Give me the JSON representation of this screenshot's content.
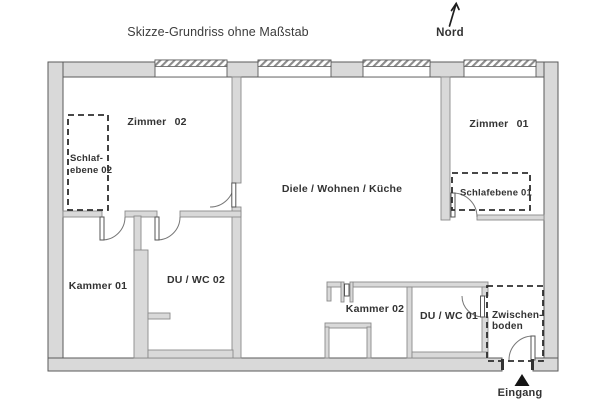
{
  "title": "Skizze-Grundriss ohne Maßstab",
  "compass": {
    "label": "Nord",
    "icon": "north-arrow-icon"
  },
  "entrance": {
    "label": "Eingang",
    "icon": "entrance-triangle-icon"
  },
  "rooms": {
    "zimmer02": {
      "label": "Zimmer 02"
    },
    "zimmer01": {
      "label": "Zimmer 01"
    },
    "diele": {
      "label": "Diele / Wohnen / Küche"
    },
    "kammer01": {
      "label": "Kammer 01"
    },
    "kammer02": {
      "label": "Kammer 02"
    },
    "du_wc_02": {
      "label": "DU / WC 02"
    },
    "du_wc_01": {
      "label": "DU / WC 01"
    },
    "schlafebene02": {
      "line1": "Schlaf-",
      "line2": "ebene 02"
    },
    "schlafebene01": {
      "label": "Schlafebene 01"
    },
    "zwischenboden": {
      "line1": "Zwischen-",
      "line2": "boden"
    }
  },
  "colors": {
    "wall_fill": "#d9d9d9",
    "wall_stroke": "#5a5a5a",
    "iwall_stroke": "#8a8a8a",
    "ink": "#333333",
    "bg": "#ffffff"
  }
}
